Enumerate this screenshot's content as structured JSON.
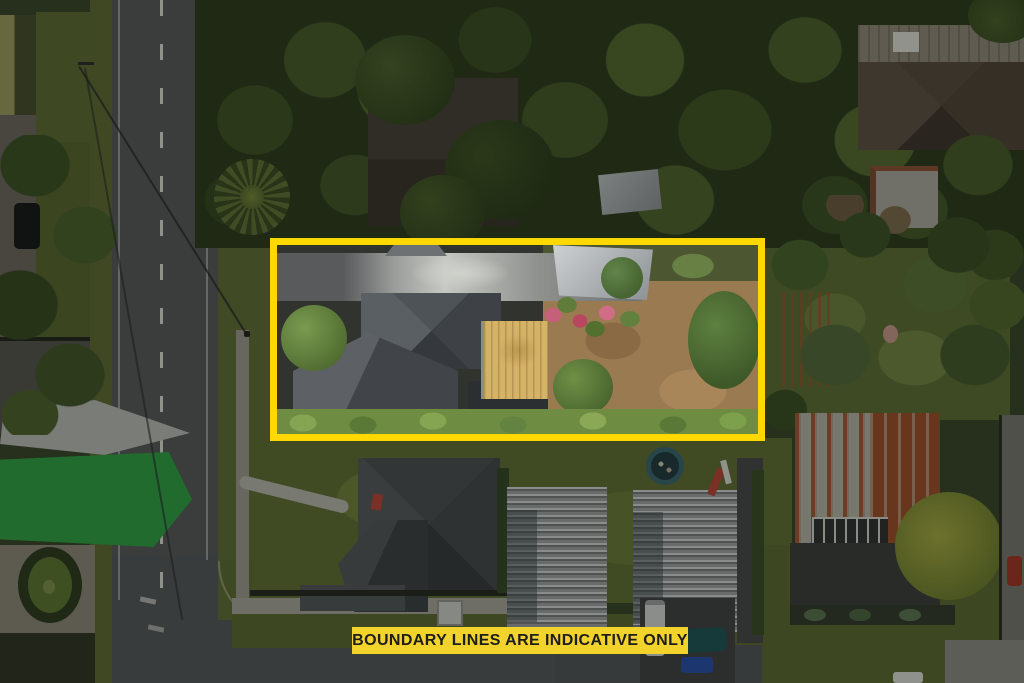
{
  "scene": {
    "description": "Aerial drone photograph of a residential property, boundary highlighted in yellow, surroundings dimmed",
    "banner": {
      "text": "BOUNDARY LINES ARE INDICATIVE ONLY",
      "background": "#F2D32B",
      "text_color": "#1D1D1B"
    },
    "boundary_box": {
      "color": "#FFD800",
      "left_px": 270,
      "top_px": 238,
      "width_px": 495,
      "height_px": 203,
      "stroke_px": 7
    },
    "overlay": {
      "dim_color": "rgba(6,9,4,0.34)"
    },
    "palette": {
      "road": "#55585A",
      "grass": "#5C6A33",
      "tree_canopy": "#2C3A1E",
      "dirt_yard": "#9A7A51",
      "main_house_roof": "#43474C",
      "garage_roof": "#9A9C9A",
      "timber_deck": "#D4B266",
      "rusty_roof": "#9A4F2C",
      "townhouse_roof": "#9EA4A6",
      "shade_sail_green": "#2F9E47",
      "trampoline": "#3B6570",
      "flower_bed_pink": "#C4607A"
    }
  }
}
